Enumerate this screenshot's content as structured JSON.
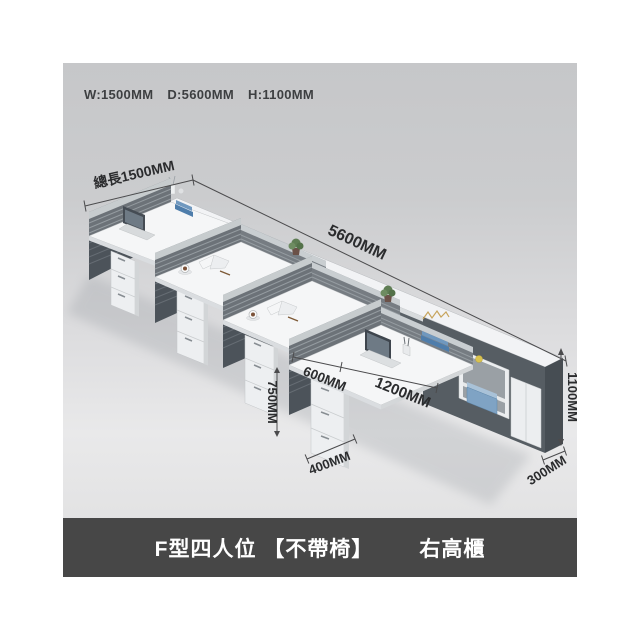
{
  "spec_header": {
    "width": "W:1500MM",
    "depth": "D:5600MM",
    "height": "H:1100MM"
  },
  "dimension_labels": {
    "total_length": "總長1500MM",
    "run_depth": "5600MM",
    "desk_height": "750MM",
    "desk_depth": "600MM",
    "desk_length": "1200MM",
    "pedestal_depth": "400MM",
    "cabinet_depth": "300MM",
    "cabinet_height": "1100MM"
  },
  "banner": {
    "model": "F型四人位 【不帶椅】",
    "option": "右高櫃"
  },
  "colors": {
    "photo_bg_top": "#c6c7c9",
    "photo_bg_bottom": "#e2e2e3",
    "banner_bg": "#474747",
    "banner_text": "#ffffff",
    "desk_top": "#f5f6f7",
    "panel_dark": "#565d63",
    "screen_gray": "#6c7278",
    "accent_blue": "#4e7dab",
    "dim_text": "#2b2c2e"
  },
  "scene": {
    "workstation_count": 4,
    "workstations": [
      {
        "id": 1,
        "items": [
          "laptop",
          "blue-folders"
        ]
      },
      {
        "id": 2,
        "items": [
          "coffee-cup",
          "open-book"
        ]
      },
      {
        "id": 3,
        "items": [
          "coffee-cup",
          "open-book"
        ]
      },
      {
        "id": 4,
        "items": [
          "laptop",
          "pen-holder",
          "blue-folders"
        ]
      }
    ],
    "cabinet": {
      "position": "right",
      "contents": [
        "open-shelves",
        "blue-storage-box",
        "white-doors",
        "yellow-cup",
        "gold-ornament"
      ]
    },
    "decor": [
      "white-vase",
      "potted-plant",
      "potted-plant",
      "shelf-cubes"
    ]
  }
}
